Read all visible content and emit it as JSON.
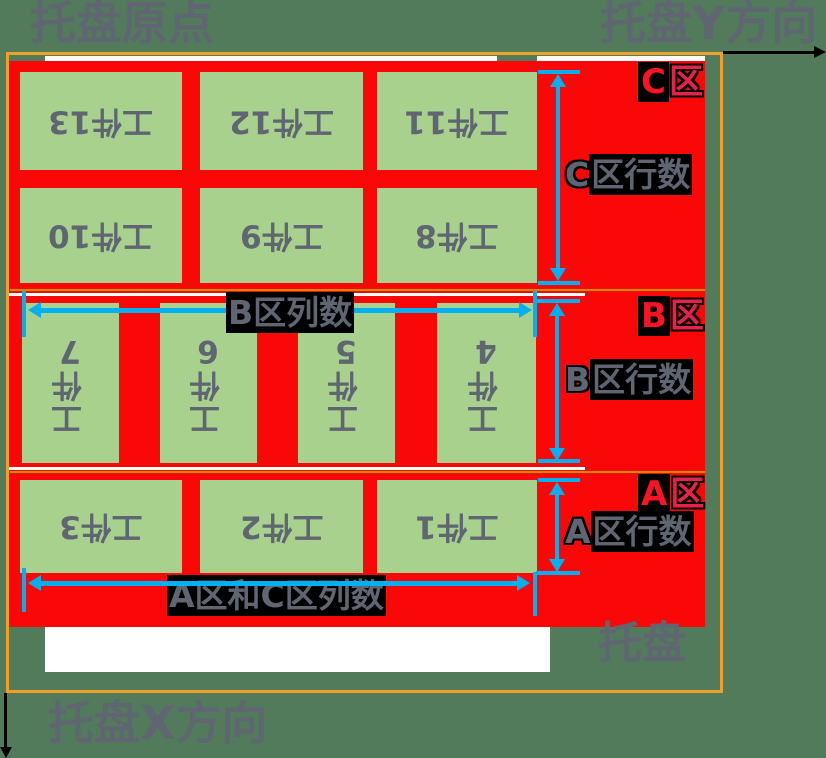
{
  "corner_labels": {
    "origin": "托盘原点",
    "y_axis": "托盘Y方向",
    "x_axis": "托盘X方向",
    "pallet": "托盘"
  },
  "zone_tags": {
    "c": {
      "letter": "C",
      "suffix": "区"
    },
    "b": {
      "letter": "B",
      "suffix": "区"
    },
    "a": {
      "letter": "A",
      "suffix": "区"
    }
  },
  "dim_labels": {
    "c_rows": {
      "first": "C",
      "rest": "区行数"
    },
    "b_rows": {
      "first": "B",
      "rest": "区行数"
    },
    "a_rows": {
      "first": "A",
      "rest": "区行数"
    },
    "b_cols": "B区列数",
    "ac_cols": "A区和C区列数"
  },
  "workpieces": {
    "zone_c_rows": [
      [
        "工件13",
        "工件12",
        "工件11"
      ],
      [
        "工件10",
        "工件9",
        "工件8"
      ]
    ],
    "zone_b_row": [
      "工件7",
      "工件6",
      "工件5",
      "工件4"
    ],
    "zone_a_row": [
      "工件3",
      "工件2",
      "工件1"
    ]
  },
  "colors": {
    "background_green": "#527B5B",
    "pallet_red": "#FA0808",
    "block_green": "#A9D18E",
    "dimension_cyan": "#00B0F0",
    "frame_orange": "#EEA028",
    "text_gray": "#5F6672",
    "zone_tag_red": "#E5234A",
    "axis_black": "#000000"
  }
}
